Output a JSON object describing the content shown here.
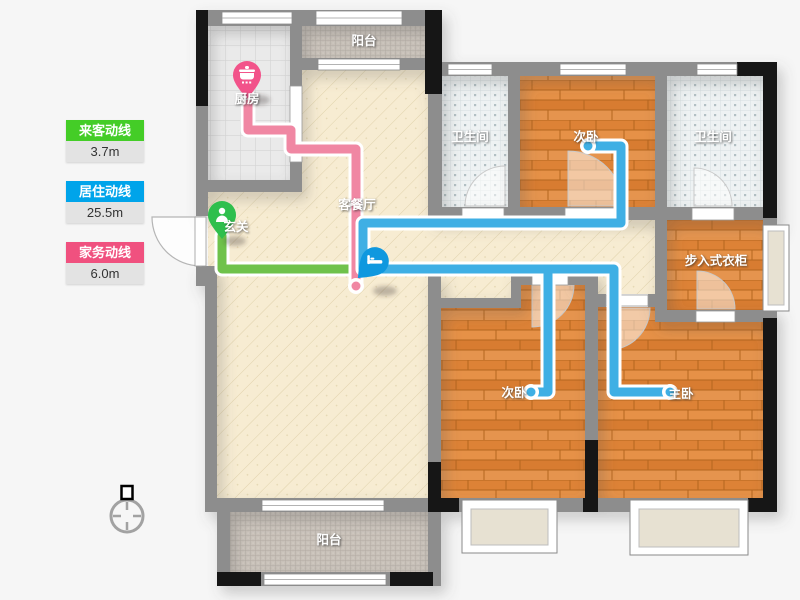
{
  "legend": {
    "items": [
      {
        "label": "来客动线",
        "value": "3.7m",
        "color": "#44cd27"
      },
      {
        "label": "居住动线",
        "value": "25.5m",
        "color": "#00a4ea"
      },
      {
        "label": "家务动线",
        "value": "6.0m",
        "color": "#f0517f"
      }
    ]
  },
  "rooms": {
    "kitchen": "厨房",
    "balcony_top": "阳台",
    "bathroom_left": "卫生间",
    "bedroom_top": "次卧",
    "bathroom_right": "卫生间",
    "living_dining": "客餐厅",
    "entry": "玄关",
    "walk_in_closet": "步入式衣柜",
    "bedroom_second": "次卧",
    "bedroom_master": "主卧",
    "balcony_bottom": "阳台"
  },
  "routes": {
    "visitor_path_color": "#6fc24b",
    "living_path_color": "#3fafe4",
    "housework_path_color": "#f087a3"
  },
  "markers": {
    "kitchen_pin": "pot-icon",
    "entry_pin": "person-icon",
    "route_marker": "bed-icon",
    "compass": "compass-icon"
  }
}
